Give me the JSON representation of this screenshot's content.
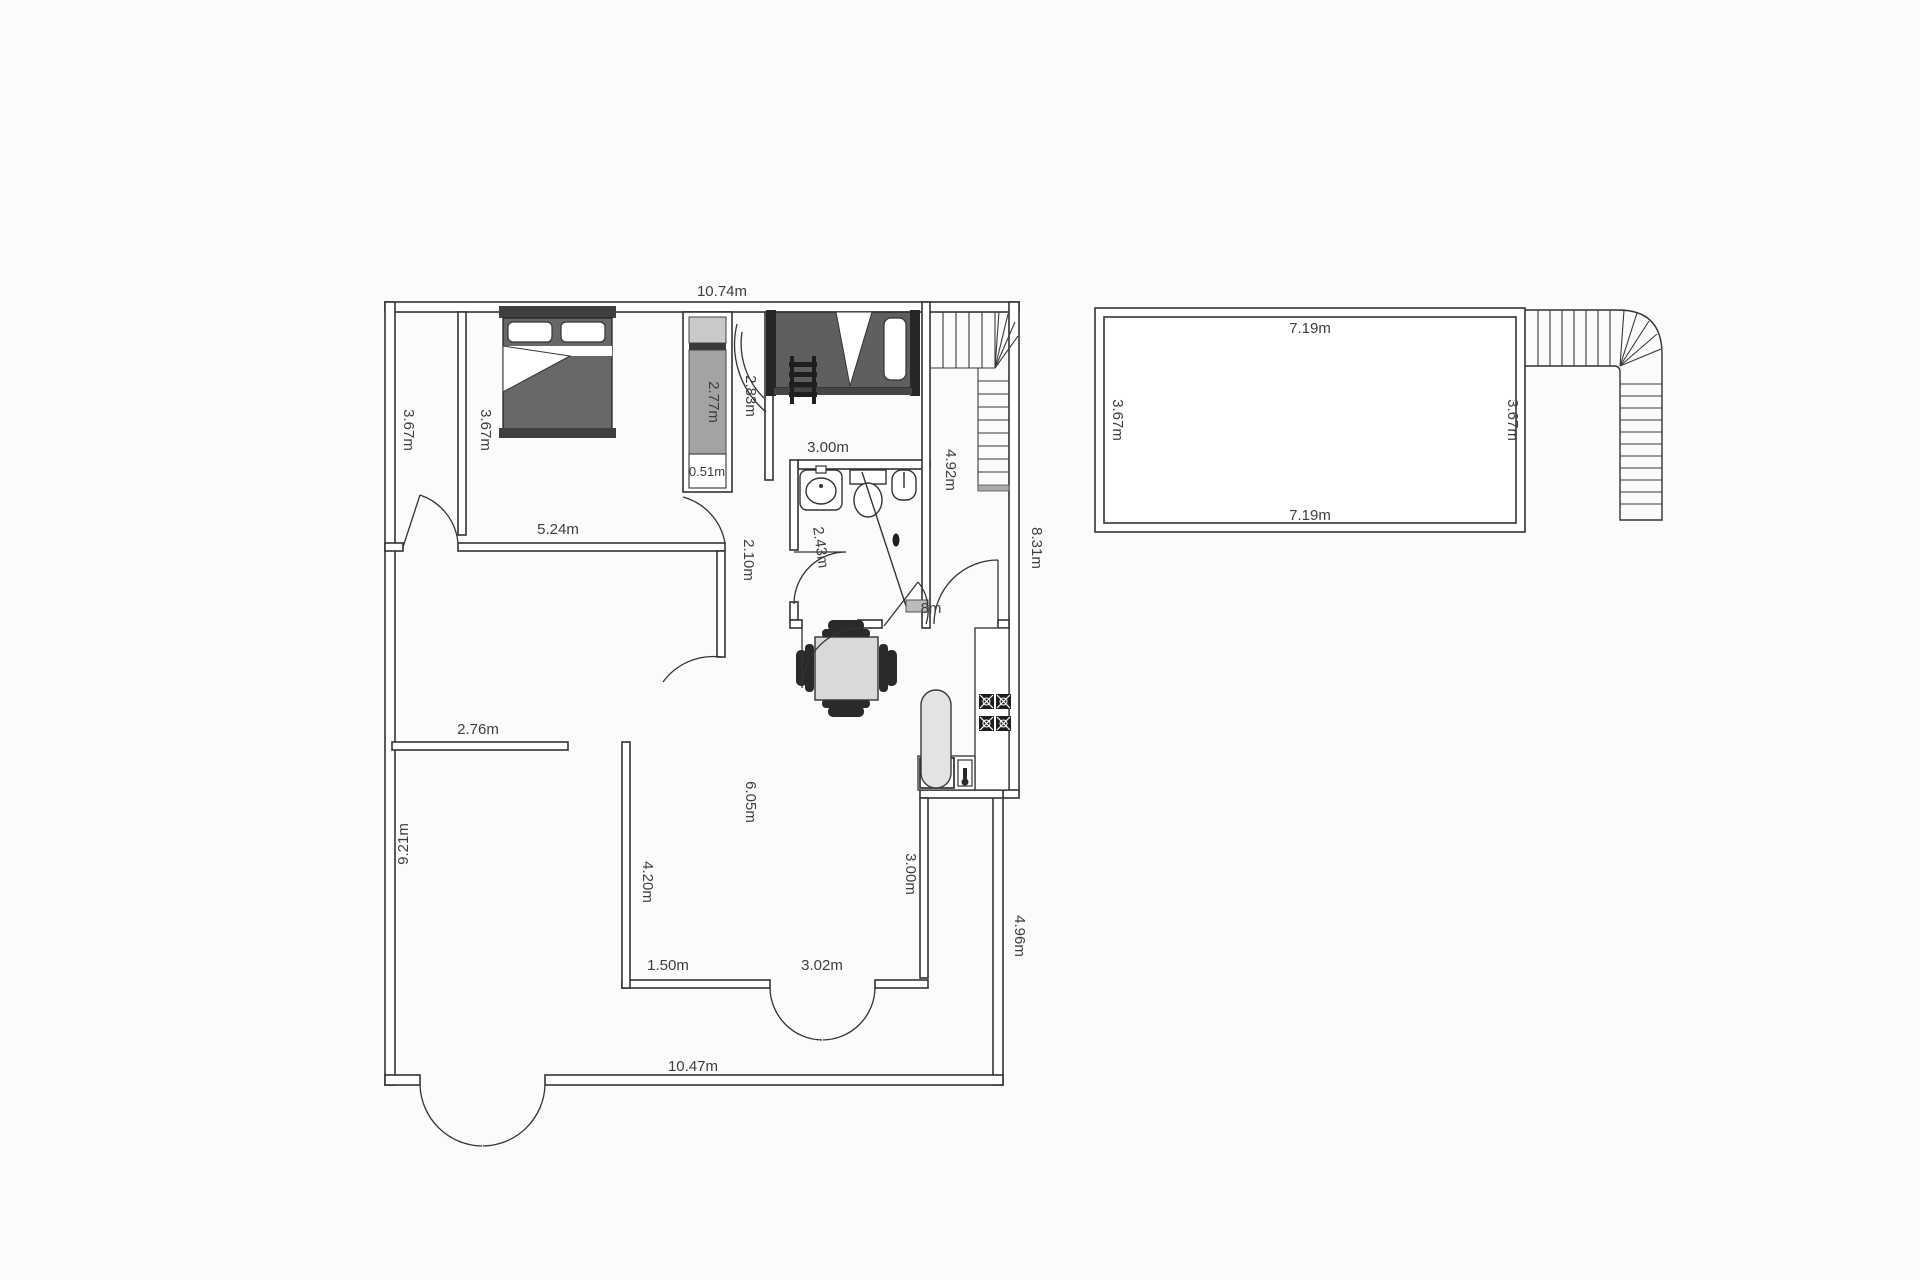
{
  "document": {
    "type": "floor-plan",
    "buildings": [
      "main-unit",
      "outbuilding"
    ]
  },
  "colors": {
    "background": "#fbfbfb",
    "wall_line": "#333333",
    "furniture_dark": "#5f5f5f",
    "headboard_dark": "#3f3f3f",
    "post_dark": "#262626",
    "closet_shelf_light": "#c9c9c9",
    "closet_gray": "#a3a3a3",
    "table_gray": "#d9d9d9",
    "stadium_gray": "#e3e3e3",
    "shower_strip_gray": "#bbbbbb",
    "label_text": "#3d3d3d"
  },
  "labels": {
    "main_top_width": {
      "text": "10.74m"
    },
    "narrow_room_height": {
      "text": "3.67m"
    },
    "bedroom1_height": {
      "text": "3.67m"
    },
    "closet_length": {
      "text": "2.77m"
    },
    "closet_width": {
      "text": "0.51m"
    },
    "bedroom2_height": {
      "text": "2.83m"
    },
    "bathroom_width": {
      "text": "3.00m"
    },
    "stair_hall_height": {
      "text": "4.92m"
    },
    "right_side_upper": {
      "text": "8.31m"
    },
    "bedroom1_width": {
      "text": "5.24m"
    },
    "hall_wall": {
      "text": "2.10m"
    },
    "bathroom_door": {
      "text": "2.43m"
    },
    "partial_dim": {
      "text": "8m"
    },
    "den_wall_width": {
      "text": "2.76m"
    },
    "left_hall_height": {
      "text": "9.21m"
    },
    "den_wall_height": {
      "text": "4.20m"
    },
    "living_height": {
      "text": "6.05m"
    },
    "kitchen_wall_height": {
      "text": "3.00m"
    },
    "bottom_seg_left": {
      "text": "1.50m"
    },
    "bottom_seg_right": {
      "text": "3.02m"
    },
    "right_side_lower": {
      "text": "4.96m"
    },
    "main_bottom_width": {
      "text": "10.47m"
    },
    "dishwasher": {
      "text": "DW"
    },
    "outbuilding_top": {
      "text": "7.19m"
    },
    "outbuilding_bottom": {
      "text": "7.19m"
    },
    "outbuilding_left": {
      "text": "3.67m"
    },
    "outbuilding_right": {
      "text": "3.67m"
    }
  }
}
